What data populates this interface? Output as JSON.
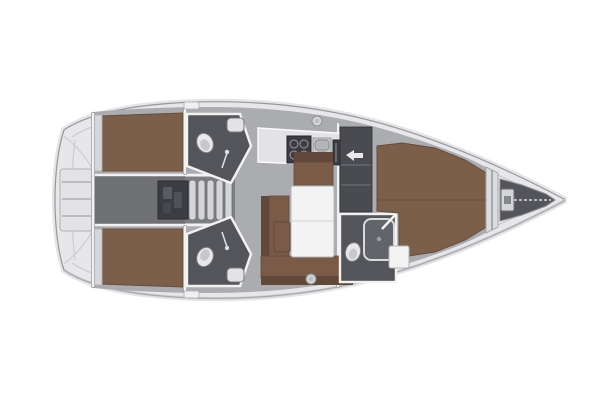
{
  "diagram": {
    "type": "floor-plan",
    "subject": "sailing-yacht-interior-layout",
    "view": "top-down",
    "orientation": "bow-right",
    "rooms": [
      "stern-swim-platform",
      "aft-cabin-port",
      "aft-cabin-starboard",
      "engine-compartment",
      "companionway-stairs",
      "aft-head-port",
      "aft-head-starboard",
      "galley",
      "salon",
      "forward-vestibule",
      "forward-head",
      "forward-cabin",
      "anchor-locker"
    ],
    "fixtures": [
      "double-berth",
      "v-berth",
      "toilet",
      "sink",
      "shower",
      "stove",
      "galley-sink",
      "refrigerator",
      "salon-table",
      "settee",
      "bench-seat",
      "stool",
      "wardrobe-arrow",
      "windlass",
      "anchor-chain",
      "winch",
      "deck-hatch",
      "transom-steps"
    ]
  },
  "colors": {
    "background": "#ffffff",
    "hull": "#e7e7e9",
    "hull_rim": "#cfd0d3",
    "outline": "#97989d",
    "interior_floor": "#abacb0",
    "corridor": "#6f7074",
    "stairwell": "#7e7f84",
    "head_floor": "#54555a",
    "vestibule": "#4a4b50",
    "dark_unit": "#3c3d42",
    "shower_tray": "#63646a",
    "bed": "#7c5f4b",
    "bed_edge": "#654c3b",
    "upholstery": "#7a5b48",
    "upholstery_back": "#62483a",
    "white_surface": "#f3f3f4",
    "porcelain": "#e8e8ea",
    "counter": "#e3e3e5",
    "platform": "#e3e3e5",
    "metal": "#d4d5d8",
    "sink_steel": "#c9cacd",
    "basin": "#b4b5b8",
    "locker_shelf": "#d6d7da",
    "bulkhead_band": "#dcdde0"
  }
}
